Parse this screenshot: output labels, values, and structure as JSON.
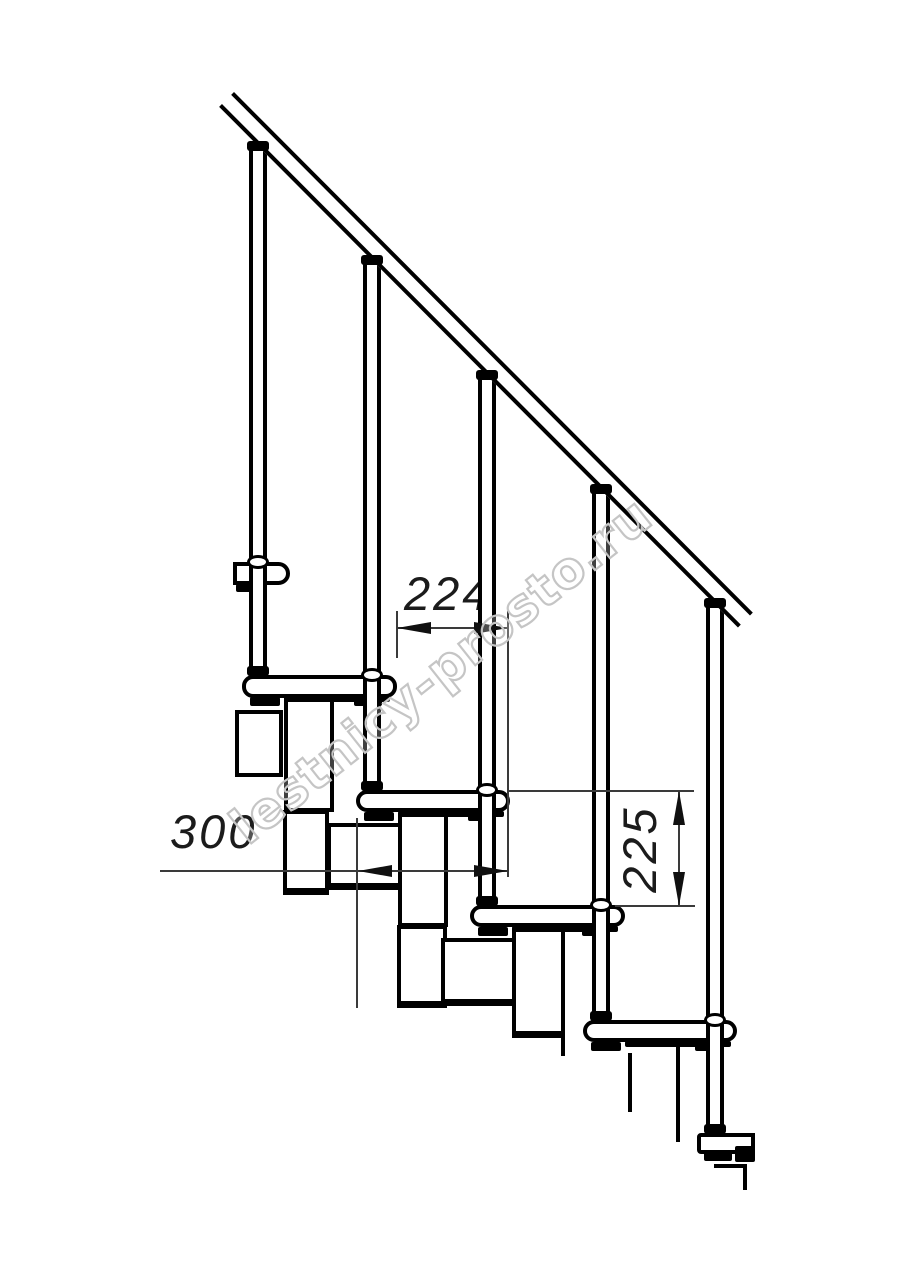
{
  "watermark": {
    "text": "lestnicy-prosto.ru",
    "color": "#c5c5c5",
    "angle_deg": -38.5
  },
  "dimensions": {
    "tread_offset": {
      "value": "224"
    },
    "step_run": {
      "value": "300"
    },
    "step_rise": {
      "value": "225"
    }
  },
  "drawing": {
    "line_color": "#000000",
    "thin_line_color": "#3a3a3a",
    "handrail": {
      "x": 234,
      "y": 92,
      "length": 735,
      "thickness": 21,
      "angle_deg": 45.1
    },
    "modules": [
      {
        "name": "module-upper-box",
        "x": 235,
        "y": 710,
        "w": 48,
        "h": 67,
        "thick": false
      },
      {
        "name": "module-neck-1",
        "x": 284,
        "y": 698,
        "w": 50,
        "h": 114,
        "thick": false
      },
      {
        "name": "module-vert-1",
        "x": 283,
        "y": 810,
        "w": 46,
        "h": 85,
        "thick": true
      },
      {
        "name": "module-body-1",
        "x": 327,
        "y": 823,
        "w": 76,
        "h": 67,
        "thick": true
      },
      {
        "name": "module-neck-2",
        "x": 398,
        "y": 813,
        "w": 50,
        "h": 114,
        "thick": false
      },
      {
        "name": "module-vert-2",
        "x": 397,
        "y": 925,
        "w": 50,
        "h": 83,
        "thick": true
      },
      {
        "name": "module-body-2",
        "x": 441,
        "y": 938,
        "w": 77,
        "h": 68,
        "thick": true
      },
      {
        "name": "module-neck-3",
        "x": 512,
        "y": 928,
        "w": 53,
        "h": 110,
        "thick": true
      }
    ],
    "partial_lines": [
      {
        "name": "partial-line-neck3",
        "x": 561,
        "y": 1038,
        "w": 4,
        "h": 18
      },
      {
        "name": "partial-line-body3",
        "x": 628,
        "y": 1053,
        "w": 4,
        "h": 59
      },
      {
        "name": "partial-line-neck4",
        "x": 676,
        "y": 1045,
        "w": 4,
        "h": 97
      },
      {
        "name": "partial-line-step5h",
        "x": 714,
        "y": 1164,
        "w": 33,
        "h": 4
      },
      {
        "name": "partial-line-step5v",
        "x": 743,
        "y": 1164,
        "w": 4,
        "h": 26
      }
    ],
    "treads": [
      {
        "name": "upper-landing-bracket",
        "x": 233,
        "y": 562,
        "w": 57,
        "h": 23,
        "r": "0 12px 12px 0"
      },
      {
        "name": "tread-1",
        "x": 242,
        "y": 675,
        "w": 155,
        "h": 23,
        "r": "11px"
      },
      {
        "name": "tread-2",
        "x": 356,
        "y": 790,
        "w": 154,
        "h": 22,
        "r": "11px"
      },
      {
        "name": "tread-3",
        "x": 470,
        "y": 905,
        "w": 155,
        "h": 22,
        "r": "11px"
      },
      {
        "name": "tread-4",
        "x": 583,
        "y": 1020,
        "w": 154,
        "h": 22,
        "r": "11px"
      },
      {
        "name": "tread-5-partial",
        "x": 697,
        "y": 1133,
        "w": 58,
        "h": 21,
        "r": "4px 0 0 4px"
      }
    ],
    "tabs": [
      {
        "name": "bracket-tab",
        "x": 236,
        "y": 584,
        "w": 16,
        "h": 8
      },
      {
        "name": "tread1-strip",
        "x": 284,
        "y": 696,
        "w": 106,
        "h": 6
      },
      {
        "name": "tread1-tab-left",
        "x": 250,
        "y": 697,
        "w": 30,
        "h": 9
      },
      {
        "name": "tread1-tab-right",
        "x": 354,
        "y": 697,
        "w": 28,
        "h": 9
      },
      {
        "name": "tread2-strip",
        "x": 398,
        "y": 811,
        "w": 106,
        "h": 6
      },
      {
        "name": "tread2-tab-left",
        "x": 364,
        "y": 812,
        "w": 30,
        "h": 9
      },
      {
        "name": "tread2-tab-right",
        "x": 468,
        "y": 812,
        "w": 28,
        "h": 9
      },
      {
        "name": "tread3-strip",
        "x": 512,
        "y": 926,
        "w": 106,
        "h": 6
      },
      {
        "name": "tread3-tab-left",
        "x": 478,
        "y": 927,
        "w": 30,
        "h": 9
      },
      {
        "name": "tread3-tab-right",
        "x": 582,
        "y": 927,
        "w": 28,
        "h": 9
      },
      {
        "name": "tread4-strip",
        "x": 625,
        "y": 1041,
        "w": 106,
        "h": 6
      },
      {
        "name": "tread4-tab-left",
        "x": 591,
        "y": 1042,
        "w": 30,
        "h": 9
      },
      {
        "name": "tread4-tab-right",
        "x": 695,
        "y": 1042,
        "w": 28,
        "h": 9
      },
      {
        "name": "tread5-tab-left",
        "x": 704,
        "y": 1152,
        "w": 28,
        "h": 9
      },
      {
        "name": "tread5-block",
        "x": 735,
        "y": 1146,
        "w": 20,
        "h": 16
      }
    ],
    "balusters": [
      {
        "name": "baluster-1",
        "x": 249,
        "y": 150,
        "h": 525
      },
      {
        "name": "baluster-2",
        "x": 363,
        "y": 264,
        "h": 526
      },
      {
        "name": "baluster-3",
        "x": 478,
        "y": 379,
        "h": 526
      },
      {
        "name": "baluster-4",
        "x": 592,
        "y": 493,
        "h": 527
      },
      {
        "name": "baluster-5",
        "x": 706,
        "y": 607,
        "h": 526
      }
    ],
    "rail_nubs": [
      {
        "name": "rail-nub-1",
        "x": 247,
        "y": 141
      },
      {
        "name": "rail-nub-2",
        "x": 361,
        "y": 255
      },
      {
        "name": "rail-nub-3",
        "x": 476,
        "y": 370
      },
      {
        "name": "rail-nub-4",
        "x": 590,
        "y": 484
      },
      {
        "name": "rail-nub-5",
        "x": 704,
        "y": 598
      }
    ],
    "landing_nubs": [
      {
        "name": "landing-nub-1",
        "x": 247,
        "y": 666
      },
      {
        "name": "landing-nub-2",
        "x": 361,
        "y": 781
      },
      {
        "name": "landing-nub-3",
        "x": 476,
        "y": 896
      },
      {
        "name": "landing-nub-4",
        "x": 590,
        "y": 1011
      },
      {
        "name": "landing-nub-5",
        "x": 704,
        "y": 1124
      }
    ],
    "collars": [
      {
        "name": "collar-1",
        "x": 247,
        "y": 555
      },
      {
        "name": "collar-2",
        "x": 361,
        "y": 668
      },
      {
        "name": "collar-3",
        "x": 476,
        "y": 783
      },
      {
        "name": "collar-4",
        "x": 590,
        "y": 898
      },
      {
        "name": "collar-5",
        "x": 704,
        "y": 1013
      }
    ],
    "dim_lines": [
      {
        "name": "dim224-line",
        "x": 397,
        "y": 627,
        "w": 111,
        "h": 2
      },
      {
        "name": "dim224-ext-left",
        "x": 396,
        "y": 611,
        "w": 2,
        "h": 47
      },
      {
        "name": "dim224-ext-right",
        "x": 507,
        "y": 611,
        "w": 2,
        "h": 266
      },
      {
        "name": "dim300-line",
        "x": 160,
        "y": 870,
        "w": 348,
        "h": 2
      },
      {
        "name": "dim300-ext-left",
        "x": 356,
        "y": 818,
        "w": 2,
        "h": 190
      },
      {
        "name": "dim225-line",
        "x": 678,
        "y": 791,
        "w": 2,
        "h": 115
      },
      {
        "name": "dim225-ext-top",
        "x": 508,
        "y": 790,
        "w": 186,
        "h": 2
      },
      {
        "name": "dim225-ext-bottom",
        "x": 615,
        "y": 905,
        "w": 80,
        "h": 2
      }
    ],
    "arrows": [
      {
        "name": "dim224-arrow-left",
        "x": 397,
        "y": 628,
        "dir": "left"
      },
      {
        "name": "dim224-arrow-right",
        "x": 508,
        "y": 628,
        "dir": "right"
      },
      {
        "name": "dim300-arrow-left",
        "x": 358,
        "y": 871,
        "dir": "left"
      },
      {
        "name": "dim300-arrow-right",
        "x": 508,
        "y": 871,
        "dir": "right"
      },
      {
        "name": "dim225-arrow-up",
        "x": 679,
        "y": 791,
        "dir": "up"
      },
      {
        "name": "dim225-arrow-down",
        "x": 679,
        "y": 906,
        "dir": "down"
      }
    ]
  }
}
